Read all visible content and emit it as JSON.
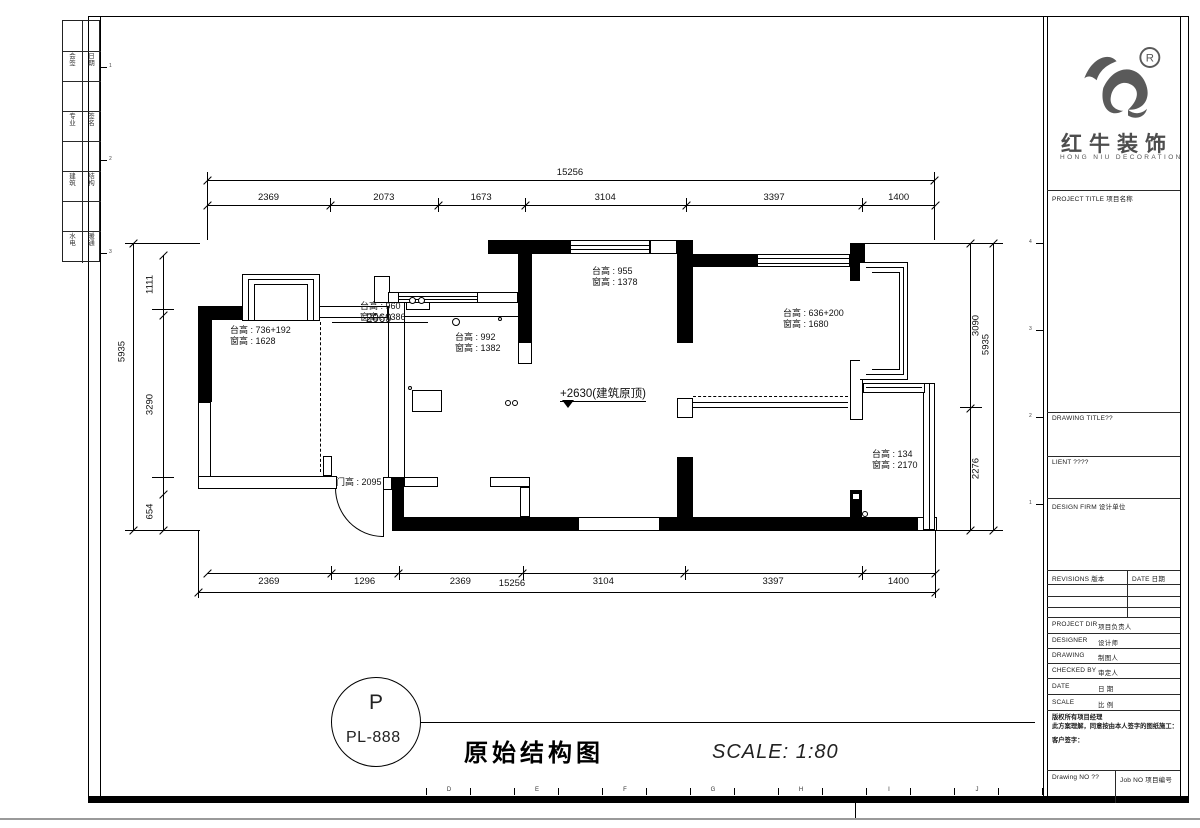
{
  "title_block": {
    "logo": {
      "registered": "®",
      "brand_cn": "红牛装饰",
      "brand_en": "HONG NIU DECORATION"
    },
    "sections": {
      "project_title": "PROJECT TITLE  项目名称",
      "drawing_title": "DRAWING TITLE??",
      "client": "LIENT ????",
      "design_firm": "DESIGN FIRM 设计单位"
    },
    "revisions_table": {
      "col1": "REVISIONS  版本",
      "col2": "DATE 日期"
    },
    "staff_rows": [
      {
        "label": "PROJECT DIR",
        "cn": "项目负责人"
      },
      {
        "label": "DESIGNER",
        "cn": "设计师"
      },
      {
        "label": "DRAWING",
        "cn": "制图人"
      },
      {
        "label": "CHECKED BY",
        "cn": "审定人"
      },
      {
        "label": "DATE",
        "cn": "日 期"
      },
      {
        "label": "SCALE",
        "cn": "比 例"
      }
    ],
    "copyright": {
      "line1": "版权所有项目经理",
      "line2": "此方案理解，同意按由本人签字的图纸施工：",
      "line3": "客户签字："
    },
    "footer": {
      "drawing_no": "Drawing NO ??",
      "job_no": "Job NO 项目编号"
    }
  },
  "plan": {
    "dimensions": {
      "top": {
        "overall": "15256",
        "segments": [
          "2369",
          "2073",
          "1673",
          "3104",
          "3397",
          "1400"
        ]
      },
      "bottom": {
        "overall": "15256",
        "segments": [
          "2369",
          "1296",
          "2369",
          "3104",
          "3397",
          "1400"
        ]
      },
      "left": {
        "overall": "5935",
        "segments": [
          "1111",
          "3290",
          "654"
        ]
      },
      "right": {
        "overall": "5935",
        "segments": [
          "3090",
          "2276"
        ]
      }
    },
    "annotations": [
      {
        "id": "a1",
        "line1": "台高 : 736+192",
        "line2": "窗高 : 1628"
      },
      {
        "id": "a2",
        "line1": "台高 : 960",
        "line2": "窗高 : 1386",
        "extra": "2069"
      },
      {
        "id": "a3",
        "line1": "台高 : 992",
        "line2": "窗高 : 1382"
      },
      {
        "id": "a4",
        "line1": "台高 : 955",
        "line2": "窗高 : 1378"
      },
      {
        "id": "a5",
        "line1": "台高 : 636+200",
        "line2": "窗高 : 1680"
      },
      {
        "id": "a6",
        "line1": "台高 : 134",
        "line2": "窗高 : 2170"
      },
      {
        "id": "a7",
        "line1": "门高 : 2095"
      },
      {
        "id": "a8",
        "line1": "+2630(建筑原顶)"
      }
    ]
  },
  "footer_strip": {
    "page_circle": {
      "top": "P",
      "bottom": "PL-888"
    },
    "drawing_name": "原始结构图",
    "scale_text": "SCALE:  1:80"
  },
  "ruler_letters": [
    "D",
    "E",
    "F",
    "G",
    "H",
    "I",
    "J"
  ],
  "edge_numbers_right": [
    "4",
    "3",
    "2",
    "1"
  ],
  "edge_numbers_left": [
    "1",
    "2",
    "3"
  ],
  "binding_strip": {
    "rows": [
      {
        "c1": "",
        "c2": ""
      },
      {
        "c1": "会签",
        "c2": "日期"
      },
      {
        "c1": "",
        "c2": ""
      },
      {
        "c1": "专业",
        "c2": "签名"
      },
      {
        "c1": "",
        "c2": ""
      },
      {
        "c1": "建筑",
        "c2": "结构"
      },
      {
        "c1": "",
        "c2": ""
      },
      {
        "c1": "水电",
        "c2": "暖通"
      }
    ]
  }
}
